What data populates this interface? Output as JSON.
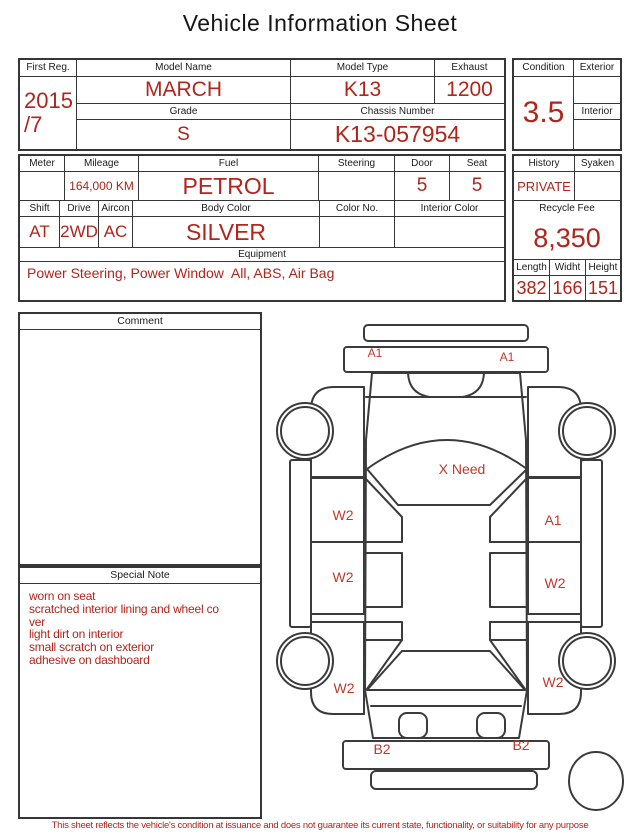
{
  "title": "Vehicle Information Sheet",
  "colors": {
    "accent_red": "#b0251c",
    "marker_red": "#c0392b",
    "line": "#363636",
    "ink": "#1a1a1a"
  },
  "section1": {
    "first_reg": {
      "label": "First Reg.",
      "value_line1": "2015",
      "value_line2": "/7"
    },
    "model_name": {
      "label": "Model Name",
      "value": "MARCH"
    },
    "model_type": {
      "label": "Model Type",
      "value": "K13"
    },
    "exhaust": {
      "label": "Exhaust",
      "value": "1200"
    },
    "grade": {
      "label": "Grade",
      "value": "S"
    },
    "chassis_number": {
      "label": "Chassis Number",
      "value": "K13-057954"
    },
    "condition": {
      "label": "Condition",
      "value": "3.5"
    },
    "exterior": {
      "label": "Exterior",
      "value": ""
    },
    "interior": {
      "label": "Interior",
      "value": ""
    }
  },
  "section2": {
    "meter": {
      "label": "Meter",
      "value": ""
    },
    "mileage": {
      "label": "Mileage",
      "value": "164,000 KM"
    },
    "fuel": {
      "label": "Fuel",
      "value": "PETROL"
    },
    "steering": {
      "label": "Steering",
      "value": ""
    },
    "door": {
      "label": "Door",
      "value": "5"
    },
    "seat": {
      "label": "Seat",
      "value": "5"
    },
    "shift": {
      "label": "Shift",
      "value": "AT"
    },
    "drive": {
      "label": "Drive",
      "value": "2WD"
    },
    "aircon": {
      "label": "Aircon",
      "value": "AC"
    },
    "body_color": {
      "label": "Body Color",
      "value": "SILVER"
    },
    "color_no": {
      "label": "Color No.",
      "value": ""
    },
    "interior_color": {
      "label": "Interior Color",
      "value": ""
    },
    "equipment": {
      "label": "Equipment",
      "value": "Power Steering, Power Window  All, ABS, Air Bag"
    },
    "history": {
      "label": "History",
      "value": "PRIVATE"
    },
    "syaken": {
      "label": "Syaken",
      "value": ""
    },
    "recycle_fee": {
      "label": "Recycle Fee",
      "value": "8,350"
    },
    "length": {
      "label": "Length",
      "value": "382"
    },
    "width": {
      "label": "Widht",
      "value": "166"
    },
    "height": {
      "label": "Height",
      "value": "151"
    }
  },
  "comment": {
    "label": "Comment",
    "text": ""
  },
  "special_note": {
    "label": "Special Note",
    "text": "worn on seat\nscratched interior lining and wheel co\nver\nlight dirt on interior\nsmall scratch on exterior\nadhesive on dashboard"
  },
  "diagram": {
    "markers": [
      {
        "area": "front-bumper-left",
        "text": "A1"
      },
      {
        "area": "front-bumper-right",
        "text": "A1"
      },
      {
        "area": "windshield",
        "text": "X Need"
      },
      {
        "area": "left-front-door",
        "text": "W2"
      },
      {
        "area": "right-front-door",
        "text": "A1"
      },
      {
        "area": "left-rear-door",
        "text": "W2"
      },
      {
        "area": "right-rear-door",
        "text": "W2"
      },
      {
        "area": "left-rear-fender",
        "text": "W2"
      },
      {
        "area": "right-rear-fender",
        "text": "W2"
      },
      {
        "area": "rear-bumper-left",
        "text": "B2"
      },
      {
        "area": "rear-bumper-right",
        "text": "B2"
      }
    ]
  },
  "footer": {
    "disclaimer": "This sheet reflects the vehicle's condition at issuance and does not guarantee its current state, functionality, or suitability for any purpose"
  }
}
